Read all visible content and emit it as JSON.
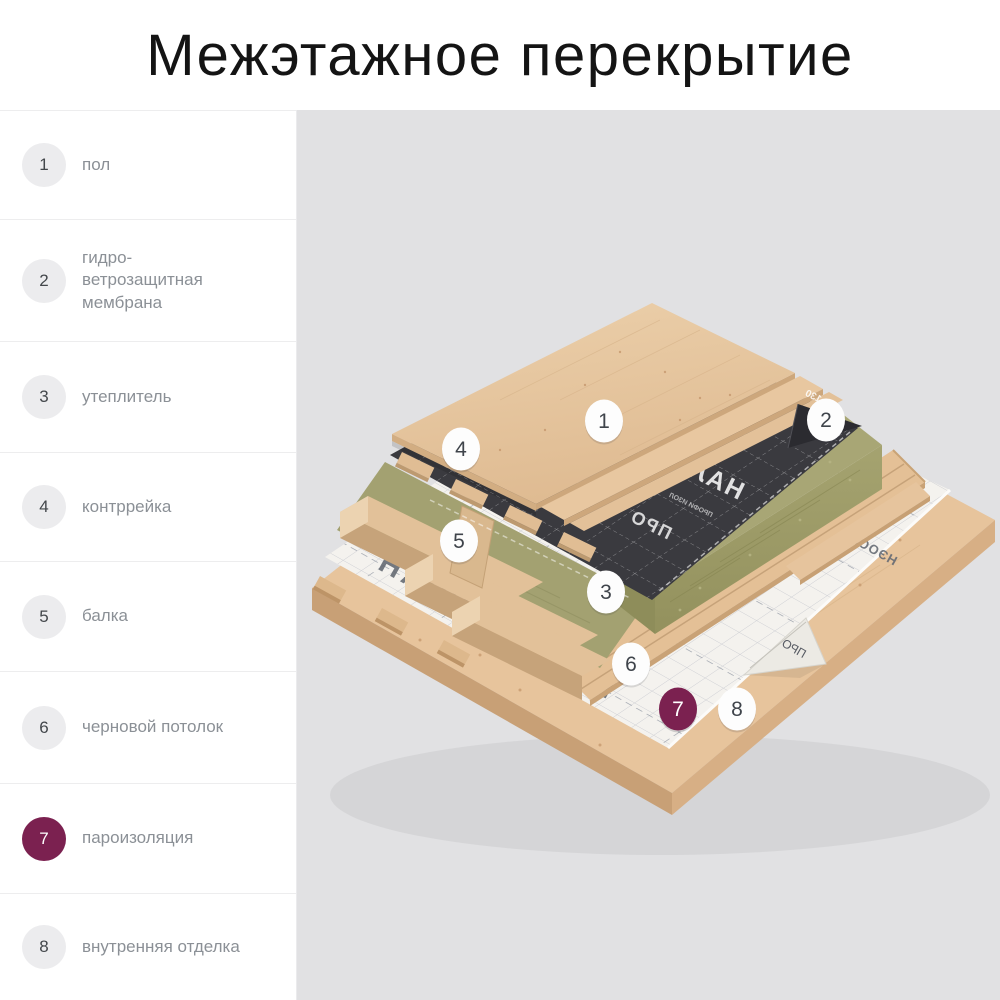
{
  "page_title": "Межэтажное перекрытие",
  "theme": {
    "accent": "#7b2150",
    "background": "#e1e1e3",
    "sidebar_background": "#ffffff",
    "label_color": "#8b9096",
    "number_color": "#43474b"
  },
  "sidebar": {
    "items": [
      {
        "number": "1",
        "label": "пол",
        "active": false
      },
      {
        "number": "2",
        "label": "гидро-\nветрозащитная\nмембрана",
        "active": false
      },
      {
        "number": "3",
        "label": "утеплитель",
        "active": false
      },
      {
        "number": "4",
        "label": "контррейка",
        "active": false
      },
      {
        "number": "5",
        "label": "балка",
        "active": false
      },
      {
        "number": "6",
        "label": "черновой потолок",
        "active": false
      },
      {
        "number": "7",
        "label": "пароизоляция",
        "active": true
      },
      {
        "number": "8",
        "label": "внутренняя отделка",
        "active": false
      }
    ]
  },
  "diagram": {
    "markers": [
      {
        "number": "1",
        "active": false
      },
      {
        "number": "2",
        "active": false
      },
      {
        "number": "3",
        "active": false
      },
      {
        "number": "4",
        "active": false
      },
      {
        "number": "5",
        "active": false
      },
      {
        "number": "6",
        "active": false
      },
      {
        "number": "7",
        "active": true
      },
      {
        "number": "8",
        "active": false
      }
    ],
    "black_membrane": {
      "brand_text": "НАЛ",
      "secondary_text": "ПРО",
      "small_text": "ПРОФИ ИЗОЛ",
      "corner_text": "130"
    },
    "white_membrane": {
      "brand_text_1": "ОСПАН",
      "brand_text_2": "НЭОСПАН",
      "brand_text_3": "НЭОСПАН",
      "fold_text": "ПРО"
    }
  }
}
